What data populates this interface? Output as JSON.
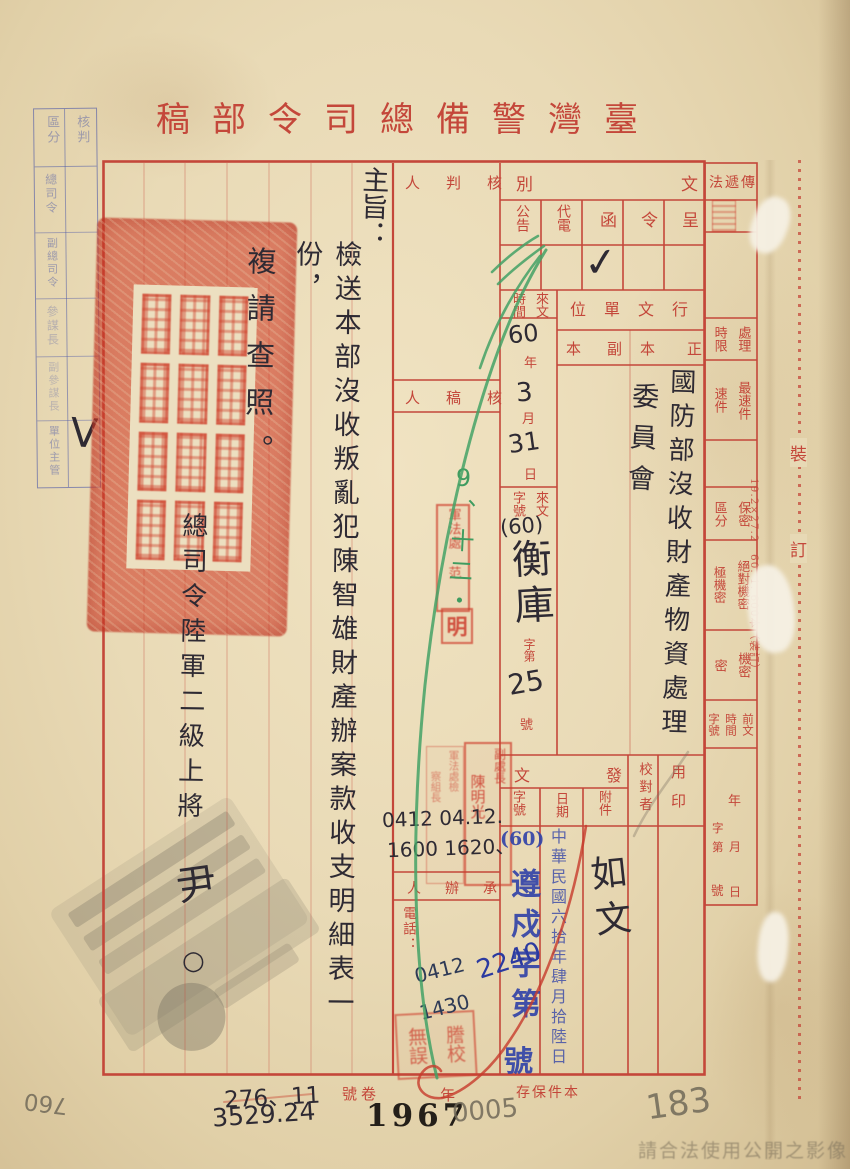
{
  "doc": {
    "title": "臺灣警備總司令部稿",
    "title_display": "稿部令司總備警灣臺",
    "watermark": "請合法使用公開之影像"
  },
  "approval_box": {
    "header_check": "核判",
    "header_category": "區分",
    "rows": [
      {
        "label": "總司令",
        "mark": ""
      },
      {
        "label": "副總司令",
        "mark": ""
      },
      {
        "label": "參謀長",
        "mark": ""
      },
      {
        "label": "副參謀長",
        "mark": ""
      },
      {
        "label": "單位主管",
        "mark": "V"
      }
    ]
  },
  "doc_class": {
    "label": "文別",
    "label_display": "別文",
    "options": [
      "呈",
      "令",
      "函",
      "代電",
      "公告"
    ],
    "selected": "函",
    "checkmark": "✓"
  },
  "transmission": {
    "label": "傳遞法",
    "label_display": "法遞傳"
  },
  "review_col": {
    "approver_display": "人判核",
    "draft_reviewer_display": "人稿核",
    "handler_display": "人辦承",
    "phone_label": "電話：",
    "hand_times_line1": "0412 04.12.",
    "hand_times_line2": "1600 1620、",
    "hand_time3": "0412",
    "hand_time4": "1430",
    "green_note": "9、十二・"
  },
  "recipients": {
    "label": "行文單位",
    "label_display": "位單文行",
    "original_display": "本正",
    "copy_display": "本副",
    "original_value_line1": "國防部沒收財產物資處理",
    "original_value_line2": "委員會"
  },
  "incoming": {
    "time_label_r": "來文",
    "time_label_l": "時間",
    "year": "60",
    "year_unit": "年",
    "month": "3",
    "month_unit": "月",
    "day": "31",
    "day_unit": "日",
    "no_label_r": "來文",
    "no_label_l": "字號",
    "no_prefix": "(60)",
    "no_word": "衡庫",
    "no_zidi": "字第",
    "no_value": "25",
    "no_hao": "號"
  },
  "right_col": {
    "deadline_r": "處理",
    "deadline_l": "時限",
    "fastest": "最速件",
    "fast": "速件",
    "secrecy_r": "保密",
    "secrecy_l": "區分",
    "top_secret": "絕對機密",
    "high_secret": "極機密",
    "secret": "機密",
    "confidential": "密",
    "prev1": "前文",
    "prev2": "時間",
    "prev3": "字號",
    "y": "年",
    "m": "月",
    "d": "日",
    "zi": "字",
    "di": "第",
    "hao": "號",
    "print_note": "19.2×27.2　60. 1. 600本（裝訂）"
  },
  "binding_line": {
    "char1": "裝",
    "char2": "訂"
  },
  "outgoing": {
    "label": "發文",
    "label_display": "文發",
    "attach_label": "附件",
    "attach_value": "如文",
    "date_label": "日期",
    "date_stamp": "中華民國六拾年肆月拾陸日",
    "no_label": "字號",
    "no_prefix": "(60)",
    "no_stamp_text": "遵戍字第",
    "no_stamp_hao": "號",
    "no_hand": "2240",
    "proofreader_label": "校對者",
    "seal_label": "用印"
  },
  "body": {
    "subject_label": "主旨：",
    "line1": "檢送本部沒收叛亂犯陳智雄財產辦案款收支明細表一份，",
    "line2": "複請查照。",
    "signer_title": "總司令陸軍二級上將",
    "signer_name": "尹",
    "signer_mark": "○"
  },
  "stamps": {
    "legal_officer": "軍法處 范",
    "ming": "明",
    "deputy_chief_r": "副處長",
    "deputy_chief_l": "陳明光",
    "section_r": "軍法處檢",
    "section_l": "察組長",
    "proof_r": "謄校",
    "proof_l": "無誤",
    "big_seal_legible": false,
    "corner_seal_legible": false
  },
  "footer": {
    "volume_label_display": "號卷",
    "year_label": "年",
    "keep_label_display": "存保件本",
    "hand_no_top": "276、11",
    "hand_no_bottom": "3529.24",
    "printed_year": "1967",
    "pencil_no": "0005",
    "pencil_page": "183",
    "pencil_side": "760"
  }
}
